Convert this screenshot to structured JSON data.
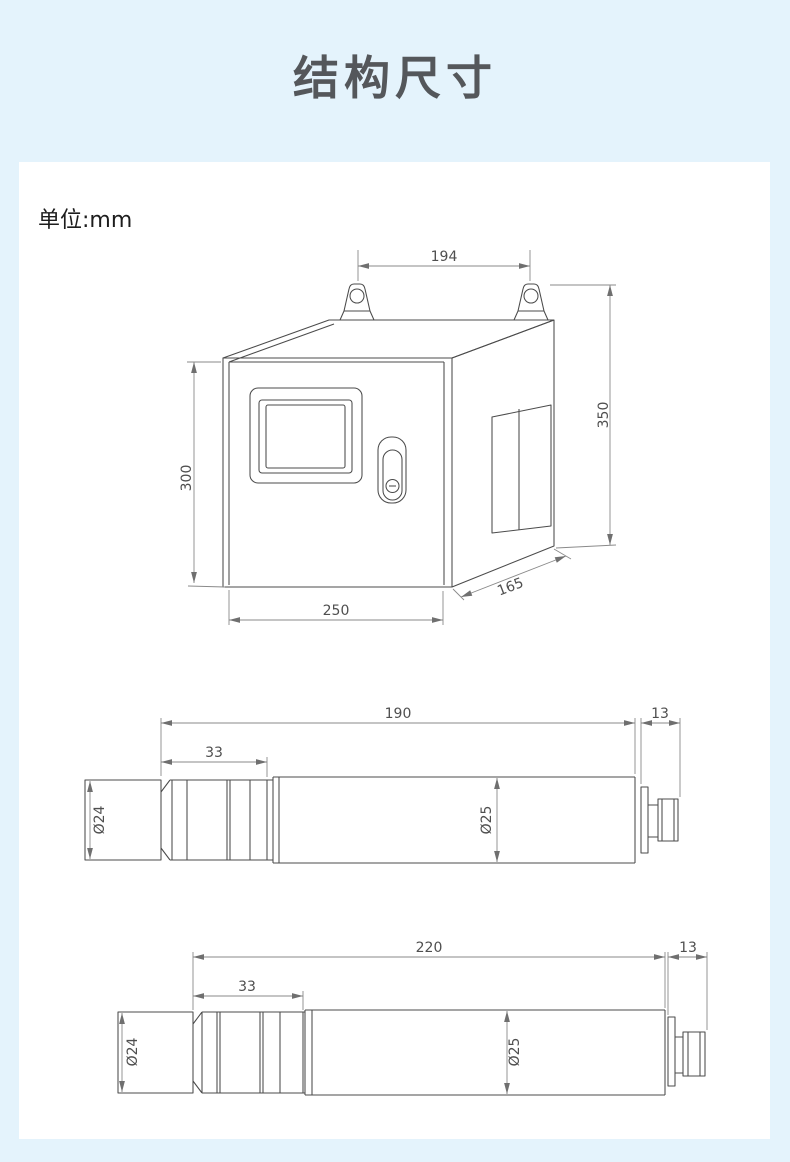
{
  "page": {
    "title": "结构尺寸",
    "unit_label": "单位:mm"
  },
  "cabinet": {
    "description": "wall-mount analyzer cabinet isometric drawing",
    "dims": {
      "mount_spacing": "194",
      "overall_height": "350",
      "front_height": "300",
      "front_width": "250",
      "depth": "165"
    }
  },
  "probe_short": {
    "description": "cylindrical sensor probe side view",
    "dims": {
      "overall_length": "190",
      "connector_length": "13",
      "head_length": "33",
      "head_diameter": "Ø24",
      "body_diameter": "Ø25"
    }
  },
  "probe_long": {
    "description": "cylindrical sensor probe side view (long)",
    "dims": {
      "overall_length": "220",
      "connector_length": "13",
      "head_length": "33",
      "head_diameter": "Ø24",
      "body_diameter": "Ø25"
    }
  },
  "colors": {
    "background": "#e4f3fc",
    "card": "#ffffff",
    "title_text": "#54575b",
    "drawing_line": "#4b4b4b",
    "dimension_line": "#8a8a8a",
    "dimension_text": "#4f4f4f"
  }
}
